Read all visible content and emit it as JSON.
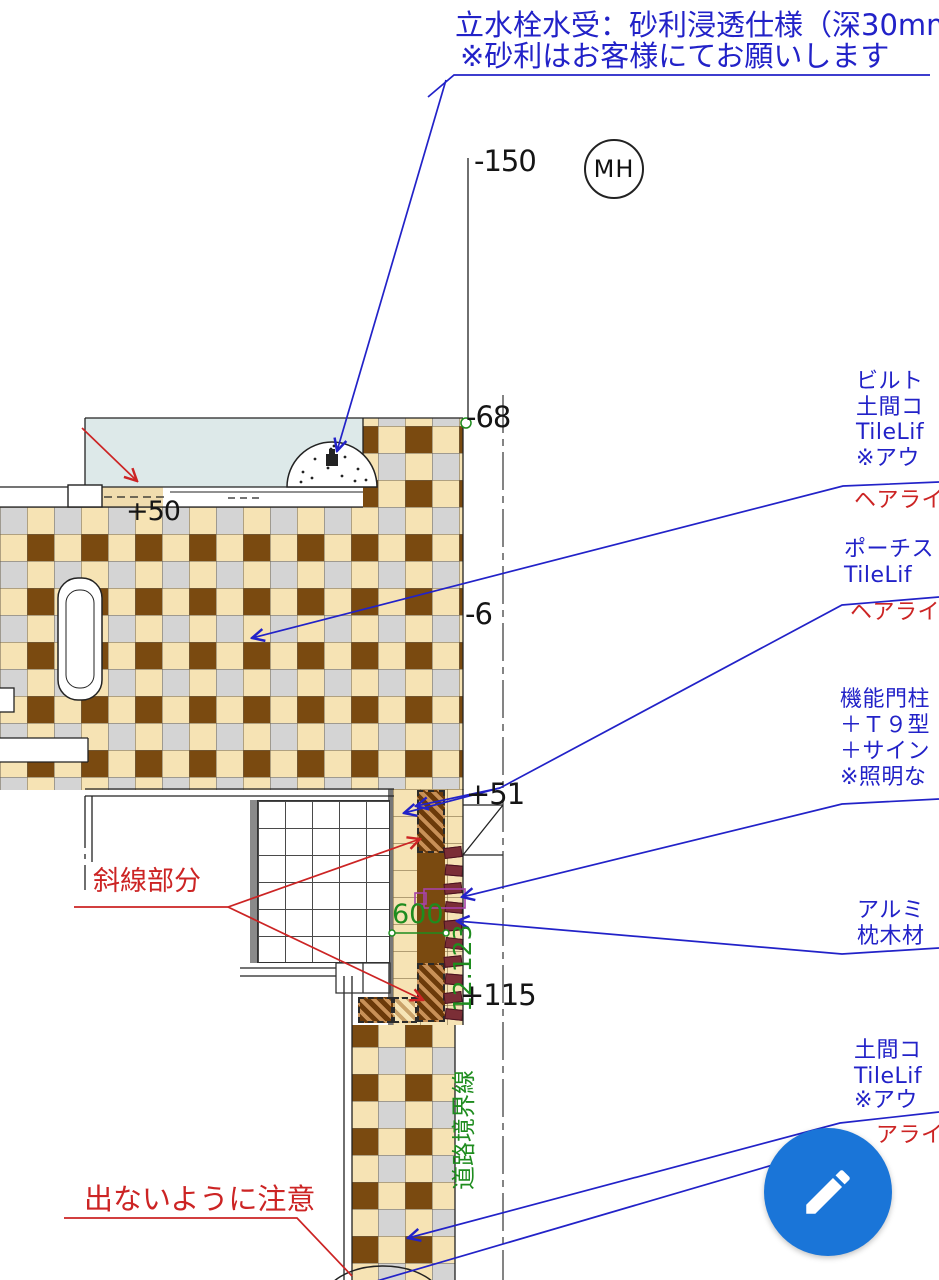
{
  "drawing": {
    "top_note_line1": "立水栓水受：砂利浸透仕様（深30mm）",
    "top_note_line2": "※砂利はお客様にてお願いします",
    "manhole": "MH",
    "levels": {
      "minus_150": "-150",
      "minus_68": "-68",
      "minus_6": "-6",
      "plus_50": "+50",
      "plus_51": "+51",
      "plus_115": "+115"
    },
    "dimensions": {
      "d600": "600",
      "d12_123": "12.123",
      "road_boundary": "道路境界線"
    },
    "red_notes": {
      "hatch_area": "斜線部分",
      "caution": "出ないように注意"
    },
    "callouts": {
      "b1_l1": "ビルト",
      "b1_l2": "土間コ",
      "b1_l3": "TileLif",
      "b1_l4": "※アウ",
      "b1_sub": "ヘアライ",
      "b2_l1": "ポーチス",
      "b2_l2": "TileLif",
      "b2_sub": "ヘアライ",
      "b3_l1": "機能門柱",
      "b3_l2": "＋Ｔ９型",
      "b3_l3": "＋サイン",
      "b3_l4": "※照明な",
      "b4_l1": "アルミ",
      "b4_l2": "枕木材",
      "b5_l1": "土間コ",
      "b5_l2": "TileLif",
      "b5_l3": "※アウ",
      "b5_sub": "アライ"
    },
    "colors": {
      "annotation_blue": "#2222c8",
      "annotation_red": "#cc2424",
      "dimension_green": "#1e8c1e",
      "tile_brown": "#7a4a10",
      "tile_cream": "#f6e3b4",
      "tile_gray": "#d4d4d4",
      "terrace_blue": "#dde9e9",
      "fab_blue": "#1a75d8"
    }
  },
  "fab": {
    "icon": "pencil"
  }
}
